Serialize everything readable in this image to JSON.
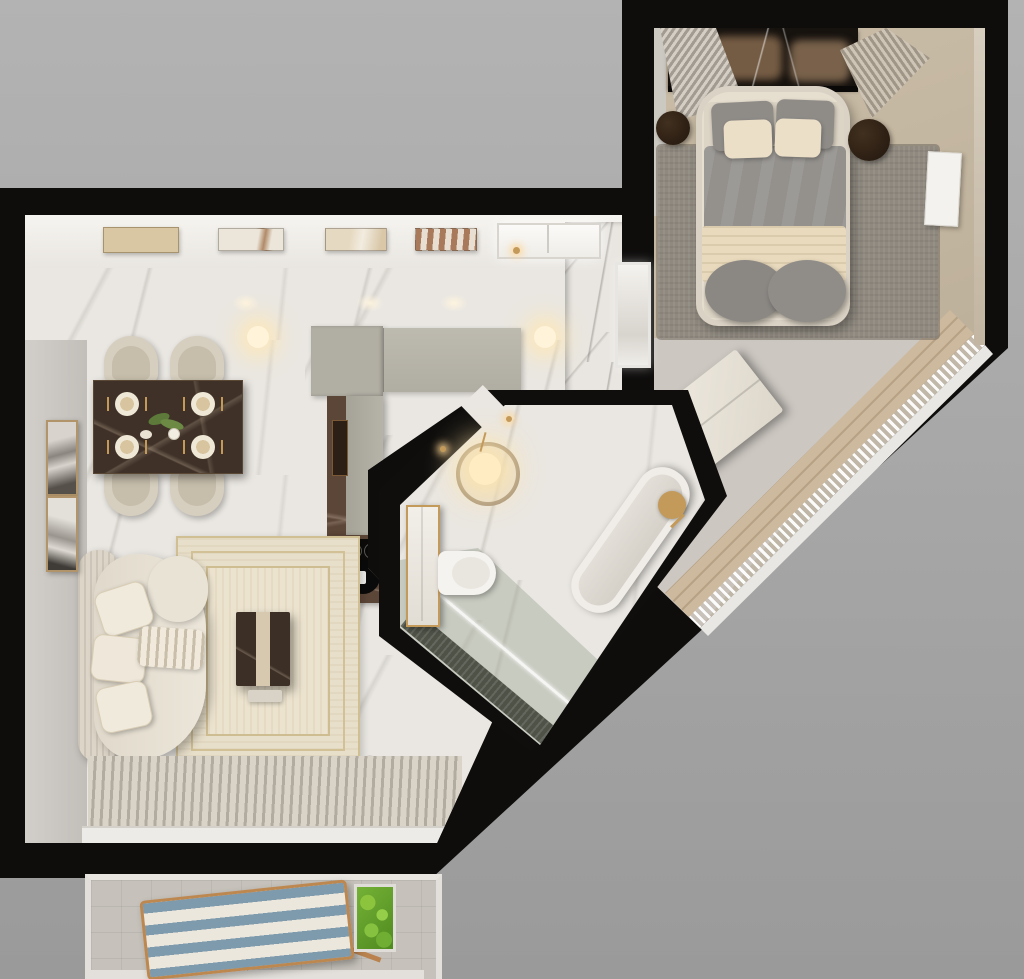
{
  "scene": {
    "name": "apartment-floor-plan-3d-render",
    "view": "top-down",
    "background_color": "#a8a8a8",
    "wall_color": "#0e0d0c"
  },
  "palette": {
    "marble_floor": "#eae7e2",
    "concrete_floor": "#cdc8c2",
    "bedroom_carpet": "#c2b5a0",
    "bedroom_rug": "#8d8780",
    "headboard_marble": "#16120e",
    "kitchen_cabinet": "#b3b0a6",
    "kitchen_counter_marble": "#5c4638",
    "dining_table_marble": "#3f3128",
    "upholstery_cream": "#e7e0d2",
    "bedding_gray": "#918e8a",
    "bedding_cream": "#e9dabd",
    "gold_accent": "#c49a5a",
    "balcony_floor": "#c6c2bb",
    "lounge_stripe_blue": "#7e9aad",
    "plant_green": "#6aa02e",
    "glow_warm": "#ffeecb"
  },
  "rooms": [
    {
      "name": "living-dining-kitchen",
      "floor": "white marble",
      "items": [
        "ceiling-artworks",
        "recessed-lights",
        "pendant-lights",
        "dining-table",
        "dining-chairs",
        "place-settings",
        "wall-art-frames",
        "kitchen-cabinets",
        "kitchen-counter",
        "cooktop",
        "kitchen-sink",
        "cutting-board",
        "kitchen-window",
        "marble-feature-wall",
        "doorway",
        "area-rug",
        "coffee-table",
        "sofa",
        "sofa-pillows",
        "throw-blanket",
        "sheer-curtain-floor",
        "window-sill"
      ]
    },
    {
      "name": "bedroom",
      "floor": "beige carpet",
      "items": [
        "marble-headboard-wall",
        "ribbed-wall-panels",
        "double-bed",
        "bed-pillows",
        "duvet",
        "bed-blanket",
        "bedroom-rug",
        "nightstand-left",
        "nightstand-right",
        "dresser",
        "floor-art-panel",
        "diagonal-window-sill",
        "sheer-curtain-diagonal",
        "wood-floor-strip"
      ]
    },
    {
      "name": "bathroom",
      "floor": "white marble",
      "items": [
        "entrance-pendant-light",
        "side-table",
        "vanity-cabinet",
        "wall-toilet",
        "bathtub",
        "gold-faucet",
        "shower-glass",
        "shower-mosaic-floor",
        "wall-sconces"
      ]
    },
    {
      "name": "balcony",
      "floor": "gray tile",
      "items": [
        "railing-frame",
        "striped-lounge-chair",
        "planter-box"
      ]
    }
  ]
}
